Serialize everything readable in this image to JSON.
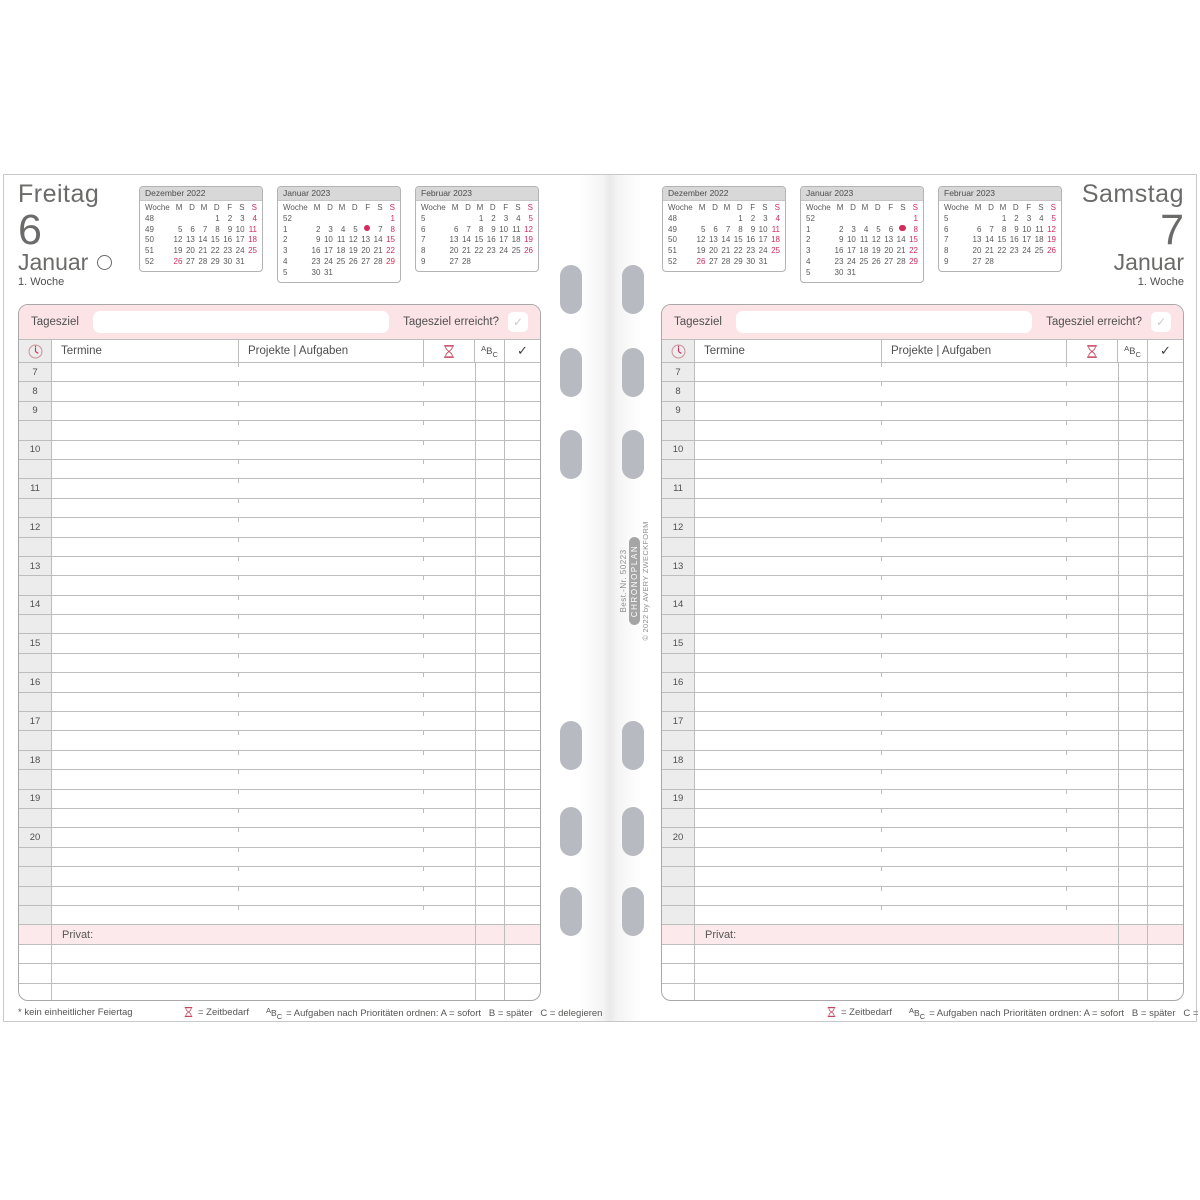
{
  "page_left": {
    "weekday": "Freitag",
    "day_number": "6",
    "month": "Januar",
    "moon_phase": "full-moon",
    "week_label": "1. Woche",
    "footer_note": "* kein einheitlicher Feiertag",
    "calendars": [
      {
        "title": "Dezember 2022",
        "week_header": "Woche",
        "day_headers": [
          "M",
          "D",
          "M",
          "D",
          "F",
          "S",
          "S!"
        ],
        "rows": [
          [
            "48",
            "",
            "",
            "",
            "1",
            "2",
            "3",
            "4!"
          ],
          [
            "49",
            "5",
            "6",
            "7",
            "8",
            "9",
            "10",
            "11!"
          ],
          [
            "50",
            "12",
            "13",
            "14",
            "15",
            "16",
            "17",
            "18!"
          ],
          [
            "51",
            "19",
            "20",
            "21",
            "22",
            "23",
            "24",
            "25!"
          ],
          [
            "52",
            "26!",
            "27",
            "28",
            "29",
            "30",
            "31",
            ""
          ]
        ]
      },
      {
        "title": "Januar 2023",
        "week_header": "Woche",
        "day_headers": [
          "M",
          "D",
          "M",
          "D",
          "F",
          "S",
          "S!"
        ],
        "rows": [
          [
            "52",
            "",
            "",
            "",
            "",
            "",
            "",
            "1!"
          ],
          [
            "1",
            "2",
            "3",
            "4",
            "5",
            "●",
            "7",
            "8!"
          ],
          [
            "2",
            "9",
            "10",
            "11",
            "12",
            "13",
            "14",
            "15!"
          ],
          [
            "3",
            "16",
            "17",
            "18",
            "19",
            "20",
            "21",
            "22!"
          ],
          [
            "4",
            "23",
            "24",
            "25",
            "26",
            "27",
            "28",
            "29!"
          ],
          [
            "5",
            "30",
            "31",
            "",
            "",
            "",
            "",
            ""
          ]
        ]
      },
      {
        "title": "Februar 2023",
        "week_header": "Woche",
        "day_headers": [
          "M",
          "D",
          "M",
          "D",
          "F",
          "S",
          "S!"
        ],
        "rows": [
          [
            "5",
            "",
            "",
            "1",
            "2",
            "3",
            "4",
            "5!"
          ],
          [
            "6",
            "6",
            "7",
            "8",
            "9",
            "10",
            "11",
            "12!"
          ],
          [
            "7",
            "13",
            "14",
            "15",
            "16",
            "17",
            "18",
            "19!"
          ],
          [
            "8",
            "20",
            "21",
            "22",
            "23",
            "24",
            "25",
            "26!"
          ],
          [
            "9",
            "27",
            "28",
            "",
            "",
            "",
            "",
            ""
          ]
        ]
      }
    ]
  },
  "page_right": {
    "weekday": "Samstag",
    "day_number": "7",
    "month": "Januar",
    "week_label": "1. Woche",
    "footer_note": "",
    "calendars": [
      {
        "title": "Dezember 2022",
        "week_header": "Woche",
        "day_headers": [
          "M",
          "D",
          "M",
          "D",
          "F",
          "S",
          "S!"
        ],
        "rows": [
          [
            "48",
            "",
            "",
            "",
            "1",
            "2",
            "3",
            "4!"
          ],
          [
            "49",
            "5",
            "6",
            "7",
            "8",
            "9",
            "10",
            "11!"
          ],
          [
            "50",
            "12",
            "13",
            "14",
            "15",
            "16",
            "17",
            "18!"
          ],
          [
            "51",
            "19",
            "20",
            "21",
            "22",
            "23",
            "24",
            "25!"
          ],
          [
            "52",
            "26!",
            "27",
            "28",
            "29",
            "30",
            "31",
            ""
          ]
        ]
      },
      {
        "title": "Januar 2023",
        "week_header": "Woche",
        "day_headers": [
          "M",
          "D",
          "M",
          "D",
          "F",
          "S",
          "S!"
        ],
        "rows": [
          [
            "52",
            "",
            "",
            "",
            "",
            "",
            "",
            "1!"
          ],
          [
            "1",
            "2",
            "3",
            "4",
            "5",
            "6",
            "●",
            "8!"
          ],
          [
            "2",
            "9",
            "10",
            "11",
            "12",
            "13",
            "14",
            "15!"
          ],
          [
            "3",
            "16",
            "17",
            "18",
            "19",
            "20",
            "21",
            "22!"
          ],
          [
            "4",
            "23",
            "24",
            "25",
            "26",
            "27",
            "28",
            "29!"
          ],
          [
            "5",
            "30",
            "31",
            "",
            "",
            "",
            "",
            ""
          ]
        ]
      },
      {
        "title": "Februar 2023",
        "week_header": "Woche",
        "day_headers": [
          "M",
          "D",
          "M",
          "D",
          "F",
          "S",
          "S!"
        ],
        "rows": [
          [
            "5",
            "",
            "",
            "1",
            "2",
            "3",
            "4",
            "5!"
          ],
          [
            "6",
            "6",
            "7",
            "8",
            "9",
            "10",
            "11",
            "12!"
          ],
          [
            "7",
            "13",
            "14",
            "15",
            "16",
            "17",
            "18",
            "19!"
          ],
          [
            "8",
            "20",
            "21",
            "22",
            "23",
            "24",
            "25",
            "26!"
          ],
          [
            "9",
            "27",
            "28",
            "",
            "",
            "",
            "",
            ""
          ]
        ]
      }
    ]
  },
  "goal_band": {
    "label": "Tagesziel",
    "input_value": "",
    "question": "Tagesziel erreicht?",
    "checkmark": "✓"
  },
  "table": {
    "headers": {
      "clock_icon": "clock-icon",
      "termine": "Termine",
      "projekte": "Projekte | Aufgaben",
      "zeit_icon": "hourglass-icon",
      "abc": [
        "A",
        "B",
        "C"
      ],
      "check": "✓"
    },
    "hours": [
      "7",
      "8",
      "9",
      "",
      "10",
      "",
      "11",
      "",
      "12",
      "",
      "13",
      "",
      "14",
      "",
      "15",
      "",
      "16",
      "",
      "17",
      "",
      "18",
      "",
      "19",
      "",
      "20",
      "",
      "",
      "",
      ""
    ],
    "privat_label": "Privat:",
    "empty_rows_after_privat": 3
  },
  "legend": {
    "zeit": "= Zeitbedarf",
    "abc_glyph": [
      "A",
      "B",
      "C"
    ],
    "abc_text": "= Aufgaben nach Prioritäten ordnen: A = sofort   B = später   C = delegieren"
  },
  "spine": {
    "order_no": "Best.-Nr. 50223",
    "brand": "CHRONOPLAN",
    "copyright": "© 2022 by AVERY ZWECKFORM"
  },
  "colors": {
    "accent": "#d22b5c",
    "pink_band": "#fbe3e6",
    "privat_pink": "#fce9eb",
    "text": "#565655",
    "grid_line": "#bdbdbd",
    "hole": "#b7bac0"
  }
}
